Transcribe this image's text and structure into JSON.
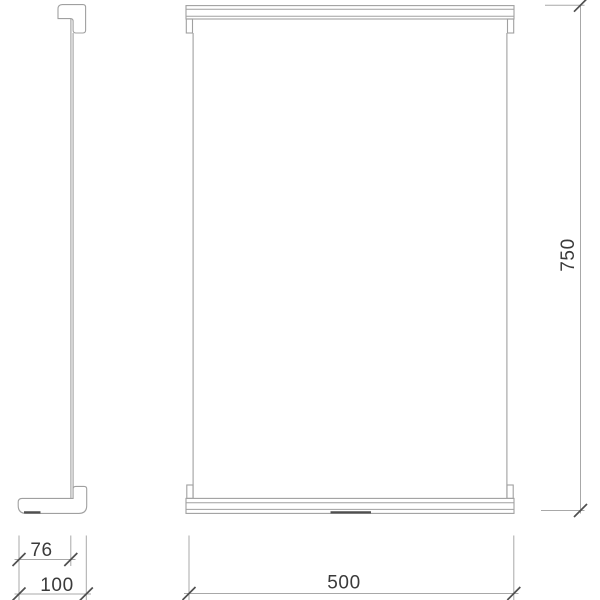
{
  "diagram": {
    "type": "technical-drawing",
    "dimensions": {
      "height_mm": "750",
      "width_mm": "500",
      "depth_inner_mm": "76",
      "depth_overall_mm": "100"
    },
    "colors": {
      "background": "#ffffff",
      "line": "#a0a0a0",
      "dim": "#a8a8a8",
      "tick": "#4f4f4f",
      "pad": "#4f4f4f",
      "text": "#3a3a3a"
    }
  }
}
